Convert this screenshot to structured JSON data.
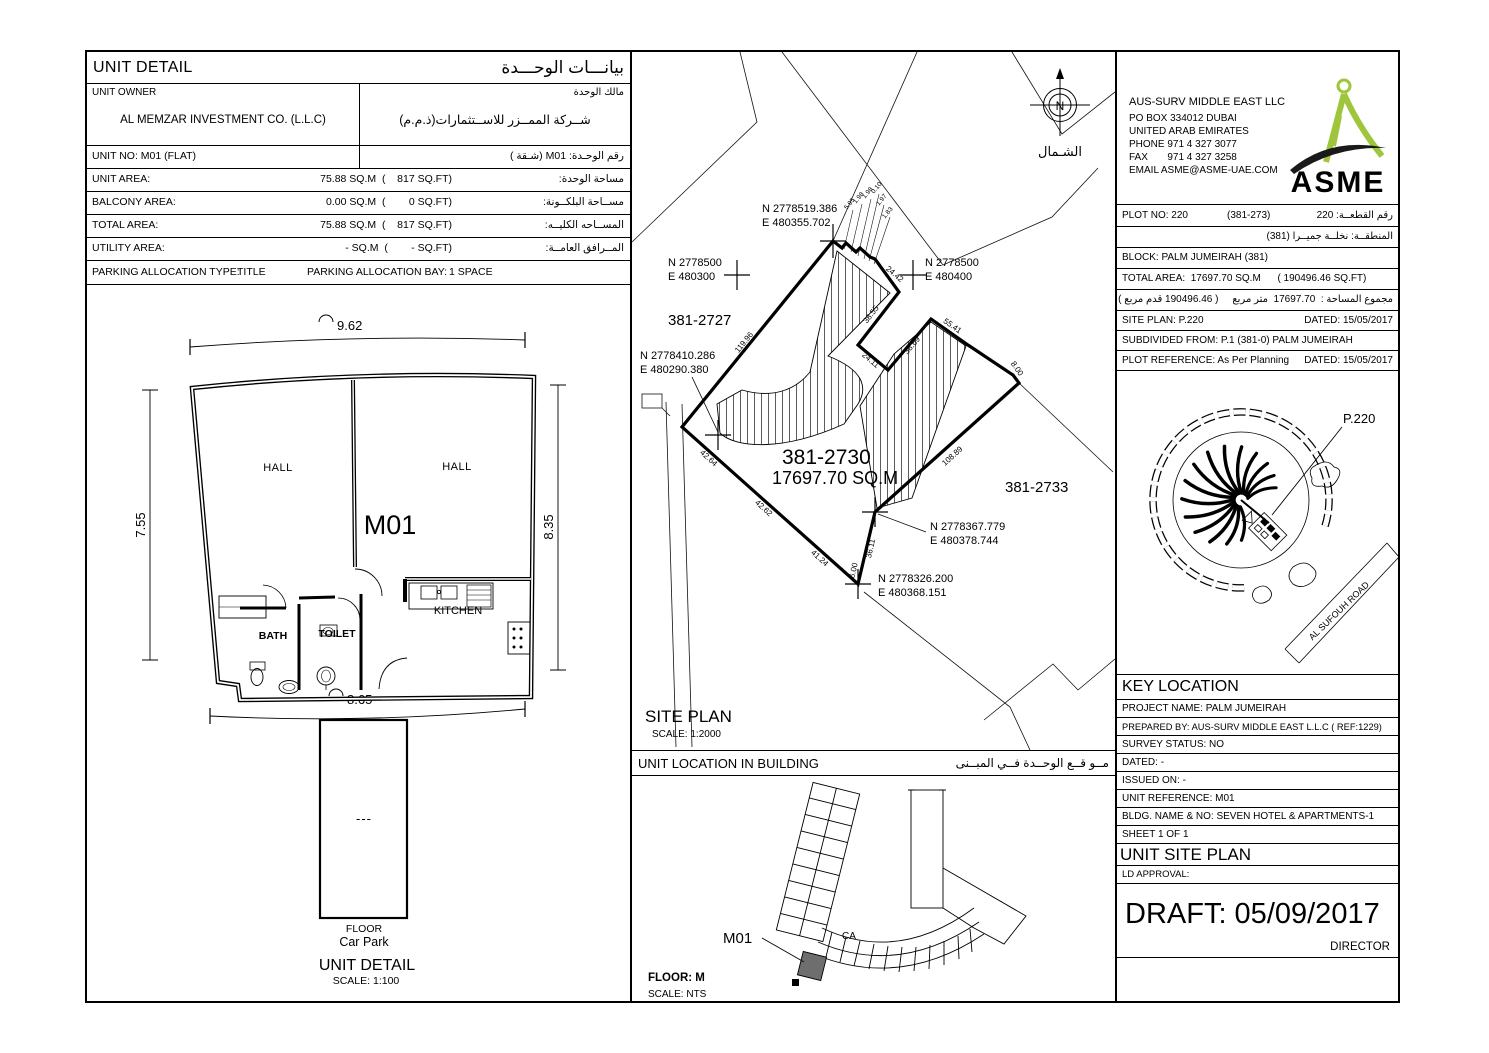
{
  "unit_detail": {
    "title_en": "UNIT DETAIL",
    "title_ar": "بيانـــات الوحـــدة",
    "owner_label": "UNIT OWNER",
    "owner_label_ar": "مالك الوحدة",
    "owner_value": "AL MEMZAR INVESTMENT CO. (L.L.C)",
    "owner_value_ar": "شــركة الممــزر للاســتثمارات(ذ.م.م)",
    "unit_no": "UNIT NO: M01   (FLAT)",
    "unit_no_ar": "رقم الوحـدة:   M01  (شـقة )",
    "rows": [
      {
        "label": "UNIT AREA:",
        "value": "75.88 SQ.M  (    817 SQ.FT)",
        "ar": "مساحة الوحدة:"
      },
      {
        "label": "BALCONY AREA:",
        "value": "0.00 SQ.M  (        0 SQ.FT)",
        "ar": "مســاحة البلكــونة:"
      },
      {
        "label": "TOTAL AREA:",
        "value": "75.88 SQ.M  (    817 SQ.FT)",
        "ar": "المســاحه الكليــه:"
      },
      {
        "label": "UTILITY AREA:",
        "value": "- SQ.M  (        - SQ.FT)",
        "ar": "المــرافق العامــة:"
      }
    ],
    "parking_type_label": "PARKING ALLOCATION TYPE:",
    "parking_type_value": "TITLE",
    "parking_bay_label": "PARKING ALLOCATION BAY:",
    "parking_bay_value": "1 SPACE"
  },
  "floor_plan": {
    "dim_top": "9.62",
    "dim_left": "7.55",
    "dim_right": "8.35",
    "dim_bottom": "8.65",
    "hall_left": "HALL",
    "hall_right": "HALL",
    "unit": "M01",
    "kitchen": "KITCHEN",
    "bath": "BATH",
    "toilet": "TOILET",
    "carpark_dash": "---",
    "floor_label": "FLOOR",
    "carpark_label": "Car Park",
    "caption": "UNIT DETAIL",
    "scale": "SCALE: 1:100"
  },
  "site_plan": {
    "caption": "SITE PLAN",
    "scale": "SCALE: 1:2000",
    "north": "N",
    "north_ar": "الشـمال",
    "plots": {
      "left": "381-2727",
      "main": "381-2730",
      "main_area": "17697.70 SQ.M",
      "right": "381-2733"
    },
    "coords": {
      "top": {
        "n": "N 2778519.386",
        "e": "E 480355.702"
      },
      "left": {
        "n": "N 2778500",
        "e": "E 480300"
      },
      "right": {
        "n": "N 2778500",
        "e": "E 480400"
      },
      "west": {
        "n": "N 2778410.286",
        "e": "E 480290.380"
      },
      "se": {
        "n": "N 2778367.779",
        "e": "E 480378.744"
      },
      "south": {
        "n": "N 2778326.200",
        "e": "E 480368.151"
      }
    },
    "edges": [
      "24.42",
      "38.55",
      "24.11",
      "38.69",
      "55.41",
      "8.00",
      "108.89",
      "36.11",
      "41.24",
      "42.62",
      "42.64",
      "119.96",
      "6.00"
    ],
    "tiny": [
      "5.95",
      "1.98",
      "1.98",
      "0.10",
      "1.97",
      "1.83"
    ]
  },
  "unit_location": {
    "title_en": "UNIT LOCATION IN BUILDING",
    "title_ar": "مــو قــع الوحــدة  فــي المبــنى",
    "unit": "M01",
    "core": "CA",
    "floor": "FLOOR: M",
    "scale": "SCALE:  NTS"
  },
  "firm": {
    "name": "AUS-SURV MIDDLE EAST LLC",
    "addr1": "PO BOX 334012 DUBAI",
    "addr2": "UNITED ARAB EMIRATES",
    "phone": "PHONE  971 4 327 3077",
    "fax": "FAX       971 4 327 3258",
    "email": "EMAIL ASME@ASME-UAE.COM",
    "logo_text": "ASME",
    "logo_green": "#9fc63b"
  },
  "plot_info": {
    "plot_no": "PLOT NO:  220",
    "plot_ref_paren": "(381-273)",
    "plot_no_ar": "رقم القطعــة:  220",
    "area_ar": "المنطقــة:  نخلــة جميــرا     (381)",
    "block": "BLOCK: PALM JUMEIRAH (381)",
    "total_area": "TOTAL AREA:  17697.70 SQ.M      ( 190496.46 SQ.FT)",
    "total_area_ar": "مجموع المساحة :  17697.70  متر مربع     ( 190496.46 قدم مربع )",
    "site_plan": "SITE PLAN: P.220",
    "site_plan_dated": "DATED: 15/05/2017",
    "subdivided": "SUBDIVIDED FROM: P.1 (381-0) PALM JUMEIRAH",
    "plot_reference": "PLOT REFERENCE: As Per Planning",
    "plot_reference_dated": "DATED: 15/05/2017"
  },
  "key_map": {
    "p220": "P.220",
    "road": "AL SUFOUH ROAD"
  },
  "key_location": {
    "title": "KEY LOCATION",
    "rows": [
      "PROJECT NAME: PALM JUMEIRAH",
      "PREPARED BY: AUS-SURV MIDDLE EAST L.L.C ( REF:1229)",
      "SURVEY STATUS:  NO",
      "DATED: -",
      "ISSUED ON: -",
      "UNIT REFERENCE: M01",
      "BLDG. NAME & NO:  SEVEN HOTEL & APARTMENTS-1",
      "SHEET  1 OF 1"
    ]
  },
  "unit_site_plan": {
    "title": "UNIT SITE PLAN",
    "ld_approval": "LD APPROVAL:",
    "draft": "DRAFT: 05/09/2017",
    "director": "DIRECTOR"
  }
}
